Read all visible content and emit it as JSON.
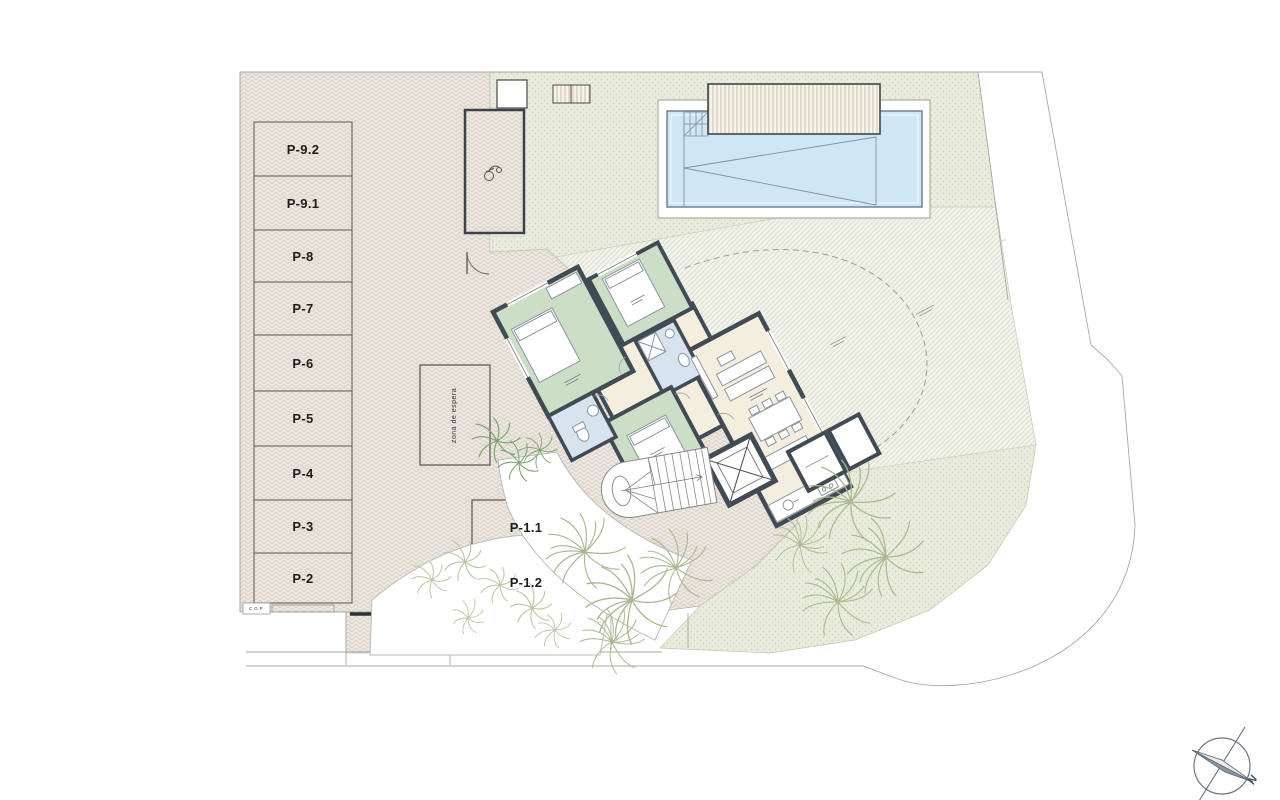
{
  "plan": {
    "parking_left": [
      "P-9.2",
      "P-9.1",
      "P-8",
      "P-7",
      "P-6",
      "P-5",
      "P-4",
      "P-3",
      "P-2"
    ],
    "parking_inner": [
      "P-1.1",
      "P-1.2"
    ],
    "waiting_zone": "zona de espera",
    "utility_label": "C.G.P.",
    "compass": {
      "north": "N"
    },
    "colors": {
      "paper": "#ffffff",
      "wall": "#414b56",
      "bedroom_green": "#cadfc6",
      "bath_blue": "#d6e4ee",
      "living_cream": "#f4eede",
      "pool_water": "#cfe6f5",
      "hatch_base": "#ece7e0",
      "garden_base": "#e9ecdd",
      "palm_green": "#a9b98e",
      "fern_green": "#79a56f"
    }
  }
}
